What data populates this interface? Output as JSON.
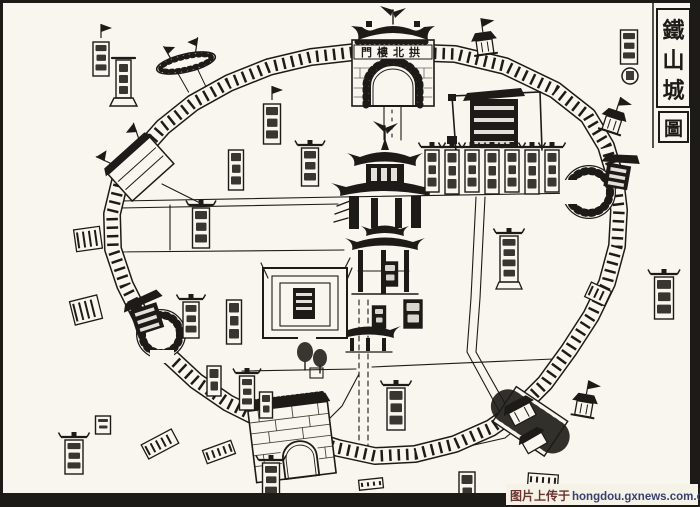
{
  "map": {
    "ink": "#1c1b17",
    "paper": "#f8f6ee",
    "title": {
      "chars": [
        "鐵",
        "山",
        "城"
      ],
      "seal": "圖"
    },
    "north_gate_label": "門樓北拱",
    "wall": {
      "points": [
        [
          400,
          52
        ],
        [
          455,
          54
        ],
        [
          505,
          66
        ],
        [
          555,
          90
        ],
        [
          588,
          116
        ],
        [
          606,
          146
        ],
        [
          615,
          176
        ],
        [
          619,
          210
        ],
        [
          617,
          246
        ],
        [
          607,
          283
        ],
        [
          591,
          316
        ],
        [
          569,
          350
        ],
        [
          545,
          383
        ],
        [
          521,
          407
        ],
        [
          491,
          428
        ],
        [
          455,
          444
        ],
        [
          415,
          454
        ],
        [
          375,
          456
        ],
        [
          338,
          448
        ],
        [
          300,
          436
        ],
        [
          264,
          421
        ],
        [
          228,
          403
        ],
        [
          196,
          381
        ],
        [
          168,
          355
        ],
        [
          143,
          321
        ],
        [
          125,
          285
        ],
        [
          113,
          249
        ],
        [
          112,
          214
        ],
        [
          120,
          181
        ],
        [
          139,
          154
        ],
        [
          163,
          127
        ],
        [
          193,
          103
        ],
        [
          229,
          83
        ],
        [
          269,
          67
        ],
        [
          311,
          57
        ],
        [
          355,
          52
        ]
      ]
    },
    "streets": [
      {
        "pts": [
          [
            120,
            201
          ],
          [
            340,
            197
          ],
          [
            583,
            193
          ]
        ]
      },
      {
        "pts": [
          [
            120,
            208
          ],
          [
            338,
            204
          ]
        ]
      },
      {
        "pts": [
          [
            113,
            252
          ],
          [
            344,
            250
          ]
        ]
      },
      {
        "pts": [
          [
            170,
            205
          ],
          [
            170,
            250
          ]
        ]
      },
      {
        "pts": [
          [
            384,
            107
          ],
          [
            384,
            140
          ]
        ]
      },
      {
        "pts": [
          [
            401,
            107
          ],
          [
            401,
            140
          ]
        ]
      },
      {
        "pts": [
          [
            392,
            110
          ],
          [
            392,
            138
          ]
        ],
        "dash": "3 5"
      },
      {
        "pts": [
          [
            359,
            300
          ],
          [
            359,
            446
          ]
        ],
        "dash": "5 4"
      },
      {
        "pts": [
          [
            368,
            300
          ],
          [
            368,
            446
          ]
        ],
        "dash": "5 4"
      },
      {
        "pts": [
          [
            476,
            197
          ],
          [
            471,
            298
          ],
          [
            467,
            352
          ]
        ]
      },
      {
        "pts": [
          [
            485,
            197
          ],
          [
            480,
            298
          ],
          [
            476,
            352
          ]
        ]
      },
      {
        "pts": [
          [
            242,
            371
          ],
          [
            356,
            369
          ]
        ]
      },
      {
        "pts": [
          [
            372,
            367
          ],
          [
            553,
            359
          ]
        ]
      },
      {
        "pts": [
          [
            467,
            352
          ],
          [
            504,
            420
          ]
        ]
      },
      {
        "pts": [
          [
            476,
            352
          ],
          [
            512,
            416
          ]
        ]
      },
      {
        "pts": [
          [
            302,
            446
          ],
          [
            342,
            406
          ],
          [
            359,
            374
          ]
        ]
      },
      {
        "pts": [
          [
            452,
            450
          ],
          [
            505,
            438
          ],
          [
            532,
            416
          ]
        ]
      },
      {
        "pts": [
          [
            162,
            184
          ],
          [
            198,
            202
          ]
        ]
      }
    ],
    "tablets": [
      {
        "cx": 272,
        "y": 104,
        "w": 17,
        "h": 40,
        "flag": true
      },
      {
        "cx": 310,
        "y": 148,
        "w": 17,
        "h": 38,
        "roof": true
      },
      {
        "cx": 236,
        "y": 150,
        "w": 15,
        "h": 40
      },
      {
        "cx": 201,
        "y": 208,
        "w": 17,
        "h": 40,
        "roof": true
      },
      {
        "cx": 191,
        "y": 302,
        "w": 16,
        "h": 36,
        "roof": true
      },
      {
        "cx": 234,
        "y": 300,
        "w": 15,
        "h": 44
      },
      {
        "cx": 214,
        "y": 366,
        "w": 14,
        "h": 30
      },
      {
        "cx": 247,
        "y": 376,
        "w": 15,
        "h": 34,
        "roof": true
      },
      {
        "cx": 266,
        "y": 392,
        "w": 13,
        "h": 26
      },
      {
        "cx": 396,
        "y": 388,
        "w": 18,
        "h": 42,
        "roof": true
      },
      {
        "cx": 509,
        "y": 236,
        "w": 18,
        "h": 46,
        "roof": true,
        "base": true
      },
      {
        "cx": 390,
        "y": 262,
        "w": 15,
        "h": 24,
        "dark": true
      },
      {
        "cx": 413,
        "y": 300,
        "w": 18,
        "h": 28,
        "dark": true
      },
      {
        "cx": 379,
        "y": 306,
        "w": 13,
        "h": 22,
        "dark": true
      },
      {
        "cx": 432,
        "y": 150,
        "w": 14,
        "h": 42,
        "roof": true
      },
      {
        "cx": 452,
        "y": 150,
        "w": 14,
        "h": 44,
        "roof": true
      },
      {
        "cx": 472,
        "y": 150,
        "w": 14,
        "h": 42,
        "roof": true
      },
      {
        "cx": 492,
        "y": 150,
        "w": 14,
        "h": 44,
        "roof": true
      },
      {
        "cx": 512,
        "y": 150,
        "w": 14,
        "h": 42,
        "roof": true
      },
      {
        "cx": 532,
        "y": 150,
        "w": 14,
        "h": 44,
        "roof": true
      },
      {
        "cx": 552,
        "y": 150,
        "w": 14,
        "h": 42,
        "roof": true
      },
      {
        "cx": 101,
        "y": 42,
        "w": 16,
        "h": 34,
        "flag": true
      },
      {
        "cx": 629,
        "y": 30,
        "w": 17,
        "h": 34
      },
      {
        "cx": 664,
        "y": 277,
        "w": 19,
        "h": 42,
        "roof": true
      },
      {
        "cx": 74,
        "y": 440,
        "w": 18,
        "h": 34,
        "roof": true
      },
      {
        "cx": 103,
        "y": 416,
        "w": 15,
        "h": 18
      },
      {
        "cx": 271,
        "y": 463,
        "w": 17,
        "h": 36,
        "roof": true
      },
      {
        "cx": 467,
        "y": 472,
        "w": 16,
        "h": 30
      }
    ],
    "towers": [
      {
        "x": 484,
        "y": 40,
        "angle": -8
      },
      {
        "x": 614,
        "y": 118,
        "angle": 18
      },
      {
        "x": 585,
        "y": 402,
        "angle": 10
      }
    ],
    "turrets": [
      {
        "x": 88,
        "y": 239,
        "w": 26,
        "h": 22,
        "angle": -8
      },
      {
        "x": 86,
        "y": 310,
        "w": 28,
        "h": 24,
        "angle": -14
      },
      {
        "x": 160,
        "y": 444,
        "w": 34,
        "h": 16,
        "angle": -28
      },
      {
        "x": 219,
        "y": 452,
        "w": 30,
        "h": 14,
        "angle": -20
      },
      {
        "x": 598,
        "y": 294,
        "w": 22,
        "h": 16,
        "angle": 25
      },
      {
        "x": 371,
        "y": 484,
        "w": 24,
        "h": 10,
        "angle": -6
      },
      {
        "x": 543,
        "y": 480,
        "w": 30,
        "h": 12,
        "angle": 4
      }
    ]
  },
  "watermark": {
    "prefix": "图片上传于",
    "url": "hongdou.gxnews.com.cn"
  }
}
